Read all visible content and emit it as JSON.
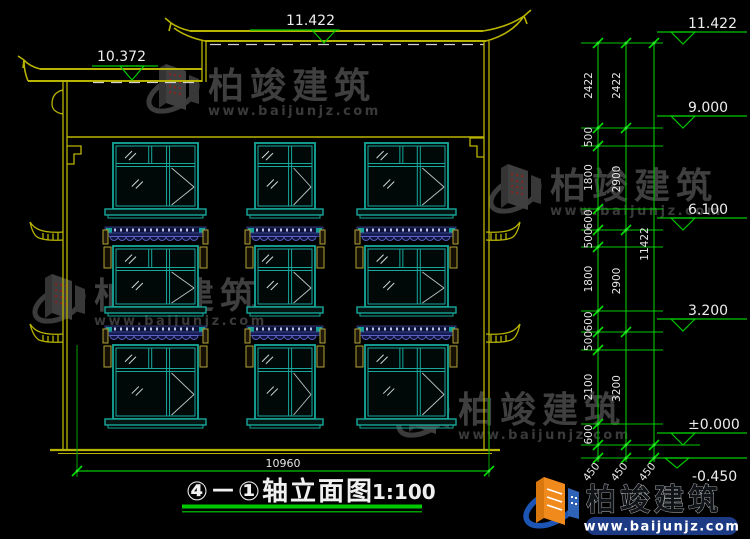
{
  "drawing": {
    "title": "④－①轴立面图",
    "scale": "1:100"
  },
  "watermark": {
    "brand": "柏竣建筑",
    "url": "www.baijunjz.com"
  },
  "markers": {
    "top_main": "11.422",
    "top_left": "10.372",
    "right": [
      "11.422",
      "9.000",
      "6.100",
      "3.200",
      "±0.000",
      "-0.450"
    ]
  },
  "dimensions": {
    "bottom_width": "10960",
    "overall_height": "11422",
    "detail_chain": [
      "2422",
      "500",
      "1800",
      "600",
      "500",
      "1800",
      "600",
      "500",
      "2100",
      "600"
    ],
    "floor_chain": [
      "2422",
      "2900",
      "2900",
      "3200"
    ],
    "foundation_offsets": [
      "450",
      "450",
      "450"
    ]
  },
  "colors": {
    "window_teal": "#17a89c",
    "dim_green": "#00c800",
    "roof_yellow": "#b9b400",
    "text_white": "#e8e8e8",
    "awning_navy": "#161b52",
    "logo_orange": "#f08a1d",
    "logo_blue": "#1c55b4",
    "watermark_gray": "#3f3f3f"
  }
}
